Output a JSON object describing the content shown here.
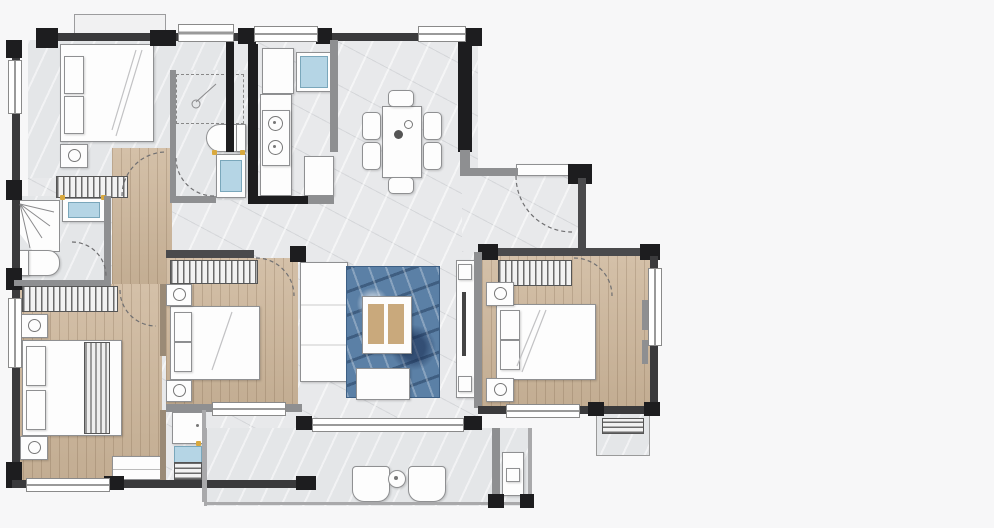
{
  "watermark": {
    "left": "世联",
    "right": "集",
    "sub": "worldunion.com"
  },
  "panel": {
    "title": "云宸",
    "title_caption": "KANG YANG CHENG",
    "badge_left": "K2幢",
    "badge_right": "K3幢",
    "area_label": "主推面积：",
    "area_value": "134",
    "area_unit": "m",
    "area_sup": "2"
  },
  "features": [
    {
      "text": "大城之上"
    },
    {
      "text": "城市繁华 诗意繁花"
    },
    {
      "text": "摘星瞰湖 撷一缕夜幕星光"
    },
    {
      "text": "极目远眺 收揽城市胜景"
    }
  ],
  "colors": {
    "accent_gold": "#c4a06a",
    "brand_teal": "#27575d",
    "divider_gold": "#b49166",
    "panel_border": "#a9bcbe",
    "wall_black": "#1d1d1f",
    "wood_floor": "#cdb69a",
    "rug_blue": "#5b80a6"
  }
}
